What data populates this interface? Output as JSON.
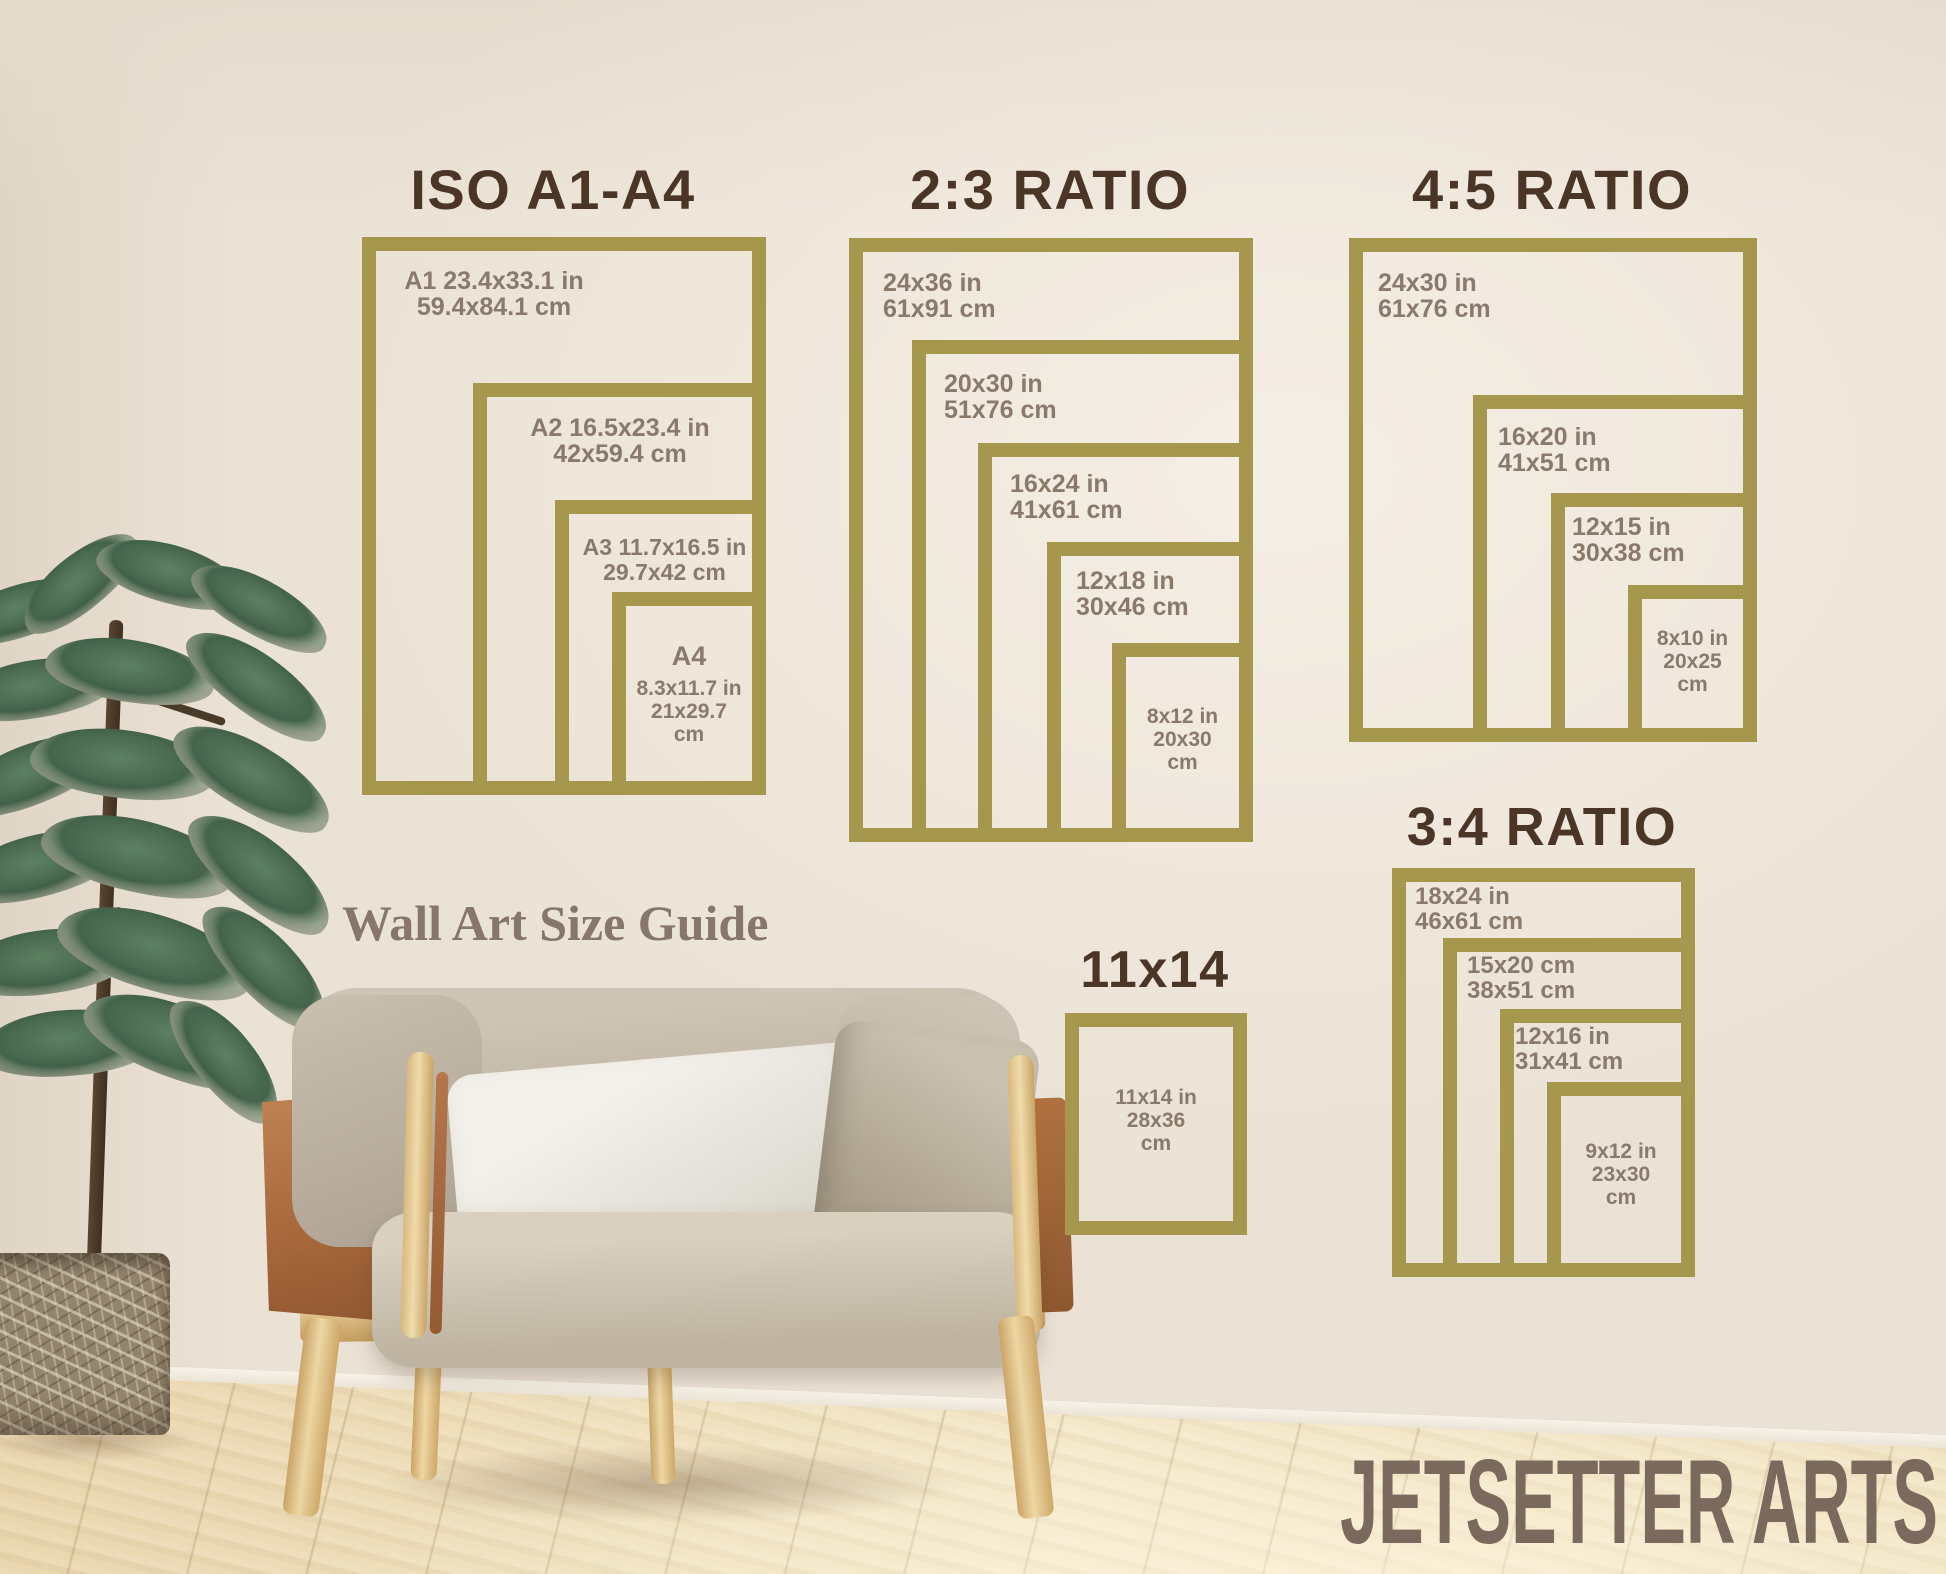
{
  "page": {
    "title": "Wall Art Size Guide"
  },
  "colors": {
    "frame_gold": "#a5974e",
    "title_brown": "#4b3526",
    "label_gray_brown": "#8a7a6b",
    "headline_brown": "#87766a",
    "brand_brown": "#7a695c",
    "wall_cream": "#ebe2d6",
    "floor_wood": "#eddcba"
  },
  "headline": {
    "text": "Wall Art Size Guide"
  },
  "brand": {
    "text": "JETSETTER ARTS"
  },
  "sections": [
    {
      "id": "iso-a1-a4",
      "title": "ISO A1-A4",
      "frames": [
        {
          "name": "A1",
          "lines": [
            "A1 23.4x33.1 in",
            "59.4x84.1 cm"
          ]
        },
        {
          "name": "A2",
          "lines": [
            "A2 16.5x23.4 in",
            "42x59.4 cm"
          ]
        },
        {
          "name": "A3",
          "lines": [
            "A3 11.7x16.5 in",
            "29.7x42 cm"
          ]
        },
        {
          "name": "A4",
          "lines": [
            "A4",
            "8.3x11.7 in",
            "21x29.7",
            "cm"
          ]
        }
      ]
    },
    {
      "id": "ratio-2-3",
      "title": "2:3 RATIO",
      "frames": [
        {
          "name": "24x36",
          "lines": [
            "24x36 in",
            "61x91 cm"
          ]
        },
        {
          "name": "20x30",
          "lines": [
            "20x30 in",
            "51x76 cm"
          ]
        },
        {
          "name": "16x24",
          "lines": [
            "16x24 in",
            "41x61 cm"
          ]
        },
        {
          "name": "12x18",
          "lines": [
            "12x18 in",
            "30x46 cm"
          ]
        },
        {
          "name": "8x12",
          "lines": [
            "8x12 in",
            "20x30",
            "cm"
          ]
        }
      ]
    },
    {
      "id": "ratio-4-5",
      "title": "4:5 RATIO",
      "frames": [
        {
          "name": "24x30",
          "lines": [
            "24x30 in",
            "61x76 cm"
          ]
        },
        {
          "name": "16x20",
          "lines": [
            "16x20 in",
            "41x51 cm"
          ]
        },
        {
          "name": "12x15",
          "lines": [
            "12x15 in",
            "30x38 cm"
          ]
        },
        {
          "name": "8x10",
          "lines": [
            "8x10 in",
            "20x25",
            "cm"
          ]
        }
      ]
    },
    {
      "id": "ratio-3-4",
      "title": "3:4 RATIO",
      "frames": [
        {
          "name": "18x24",
          "lines": [
            "18x24 in",
            "46x61 cm"
          ]
        },
        {
          "name": "15x20",
          "lines": [
            "15x20 cm",
            "38x51 cm"
          ]
        },
        {
          "name": "12x16",
          "lines": [
            "12x16 in",
            "31x41 cm"
          ]
        },
        {
          "name": "9x12",
          "lines": [
            "9x12 in",
            "23x30",
            "cm"
          ]
        }
      ]
    },
    {
      "id": "size-11x14",
      "title": "11x14",
      "frames": [
        {
          "name": "11x14",
          "lines": [
            "11x14 in",
            "28x36",
            "cm"
          ]
        }
      ]
    }
  ]
}
